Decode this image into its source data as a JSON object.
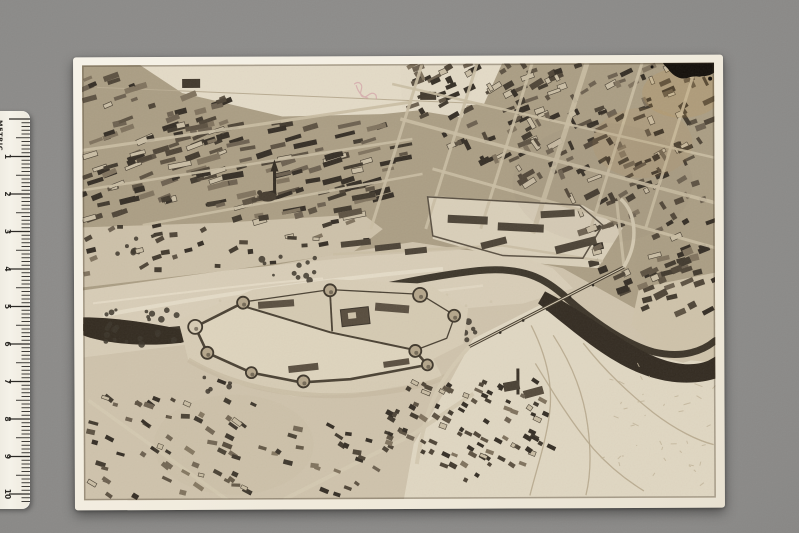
{
  "surface": {
    "color": "#8b8a88"
  },
  "ruler": {
    "label": "METRIC",
    "numbers": [
      "1",
      "2",
      "3",
      "4",
      "5",
      "6",
      "7",
      "8",
      "9",
      "10"
    ],
    "body_color": "#f1ede2",
    "tick_color": "#2c2a26"
  },
  "photograph": {
    "print_color": "#f3efe3",
    "sepia_light": "#e4dbc7",
    "sepia_mid": "#cfc3ac",
    "sepia_dark": "#3a332a",
    "water_dark": "#352d22",
    "ink_blot_color": "#130f0a",
    "red_marking_color": "#d096a0"
  }
}
